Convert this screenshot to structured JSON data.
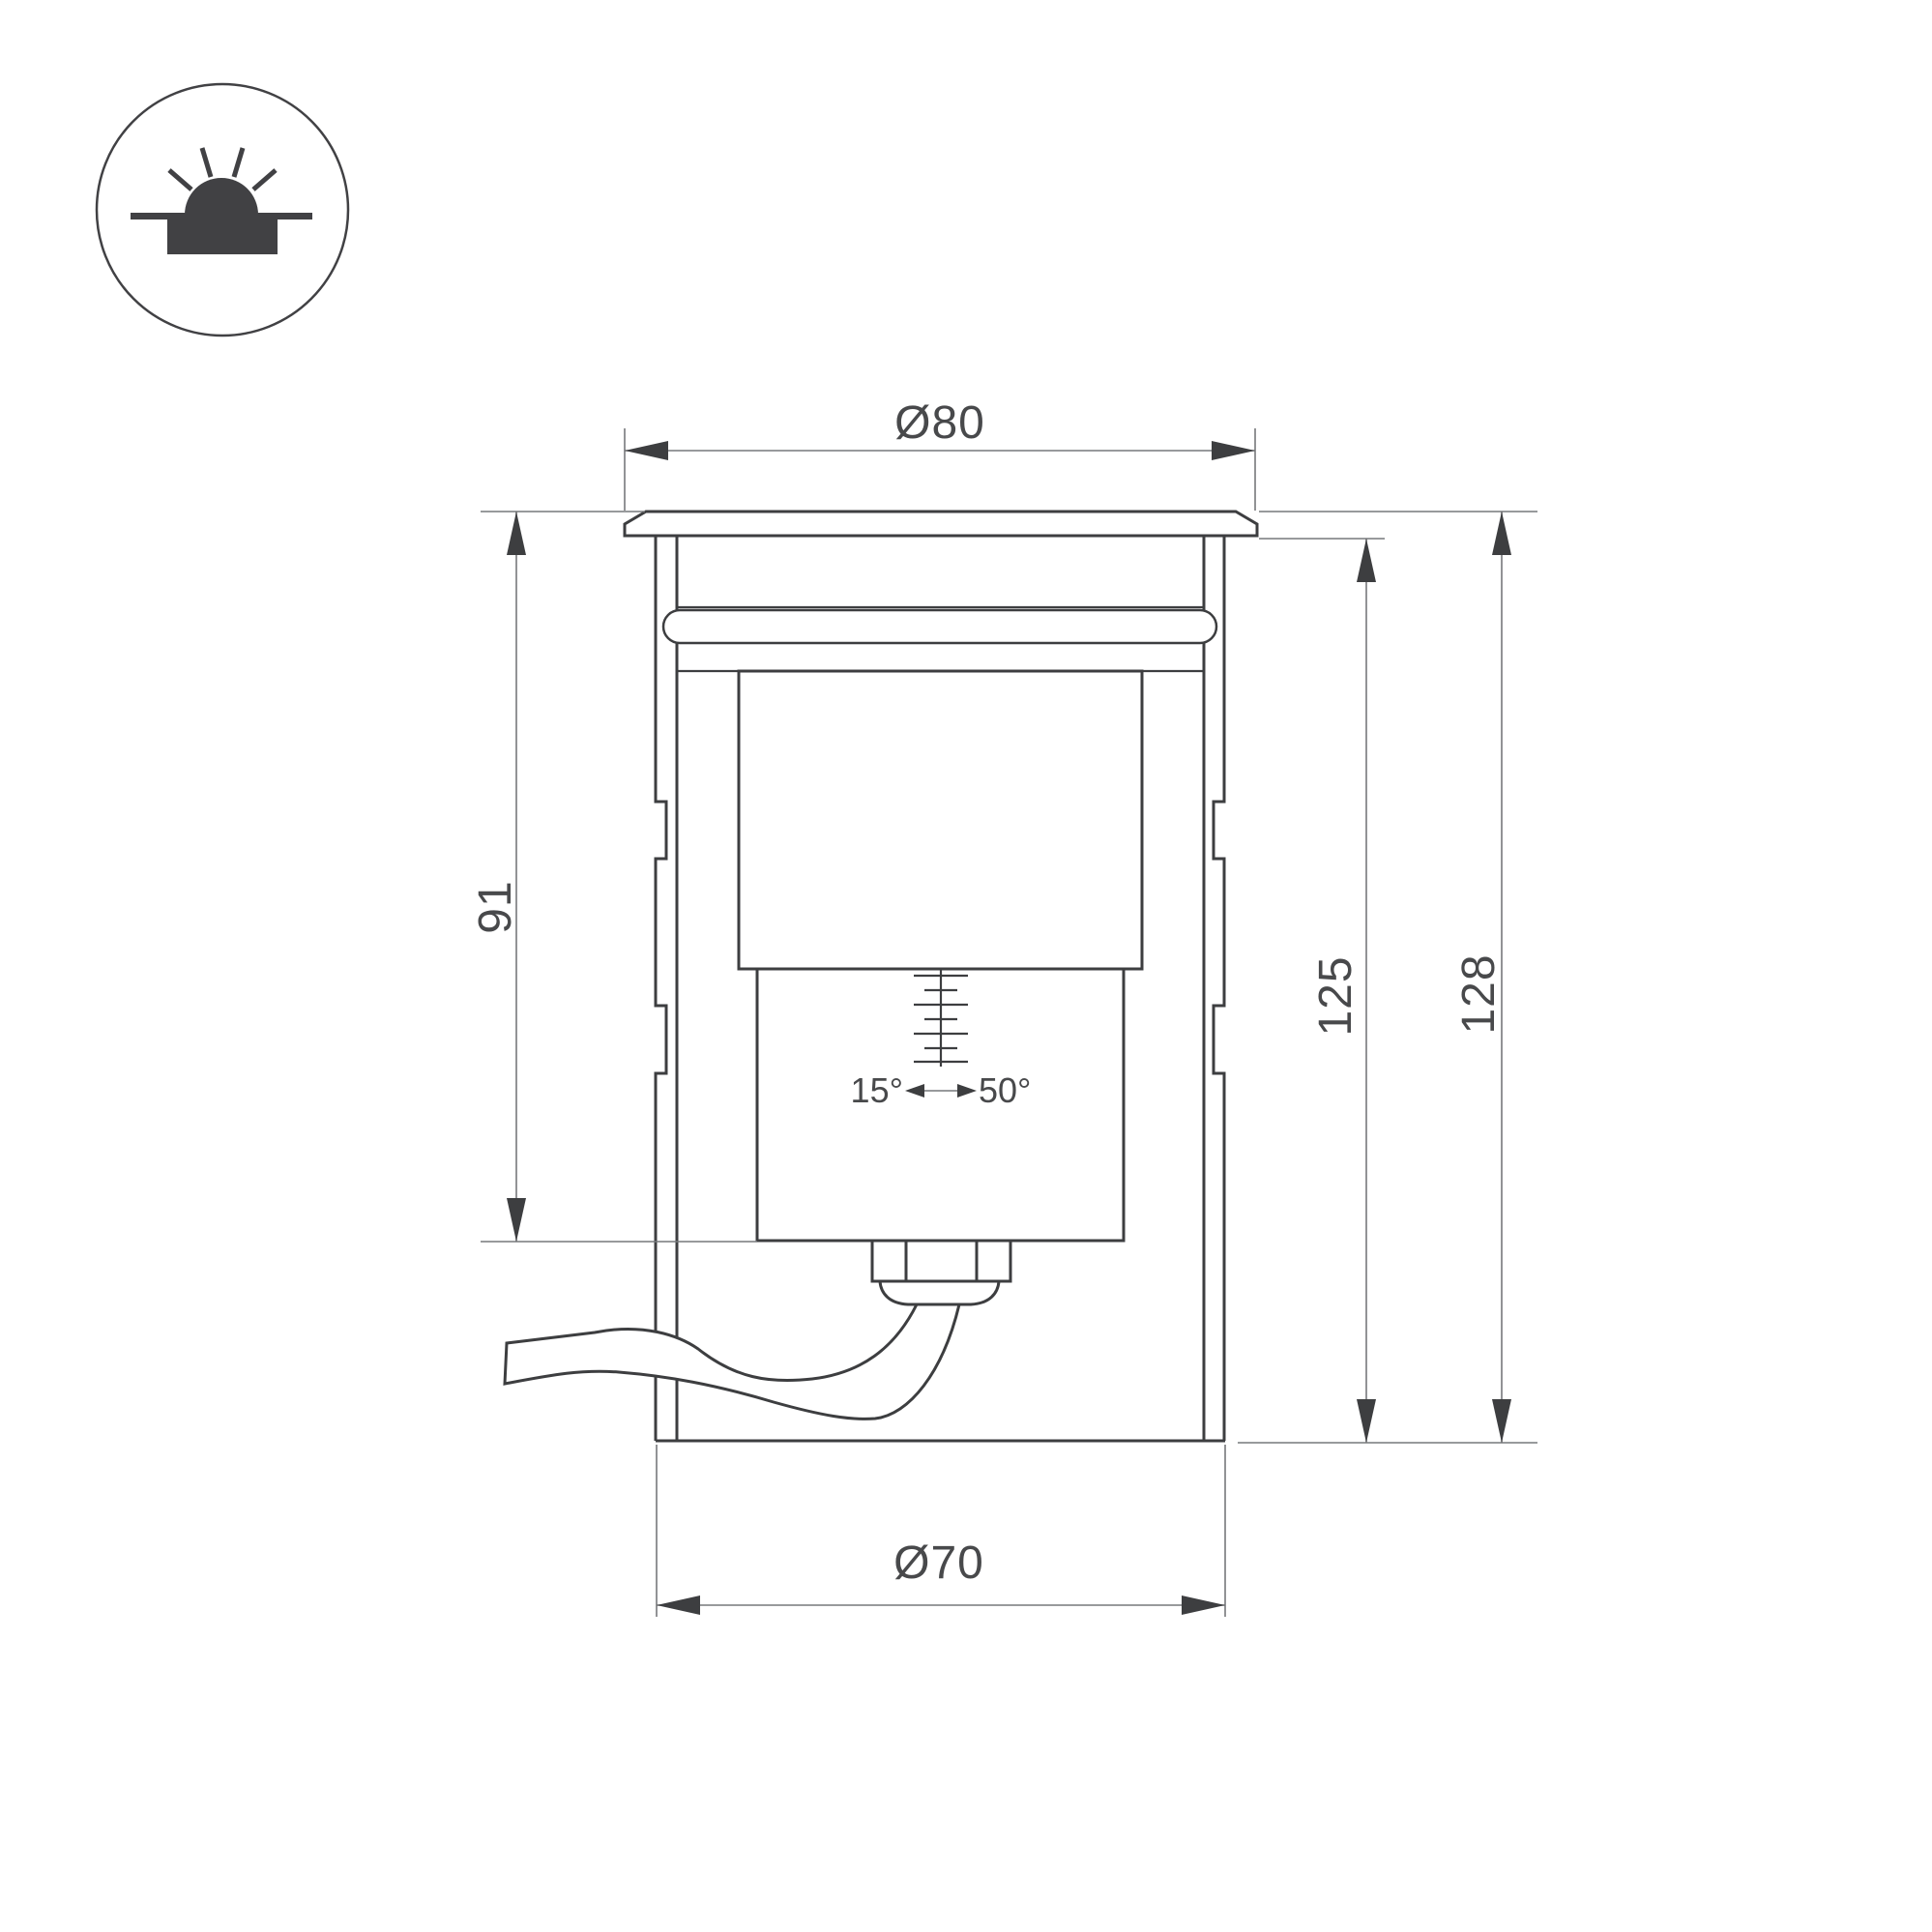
{
  "dimensions": {
    "flange_diameter": "Ø80",
    "body_diameter": "Ø70",
    "recess_depth": "91",
    "housing_height": "125",
    "overall_height": "128",
    "tilt_angle_min": "15°",
    "tilt_angle_max": "50°"
  },
  "icon": {
    "name": "recessed-ground-luminaire-icon"
  },
  "colors": {
    "line": "#3d3e40",
    "dim": "#77787b",
    "text": "#48494b",
    "icon": "#414144",
    "bg": "#ffffff"
  }
}
